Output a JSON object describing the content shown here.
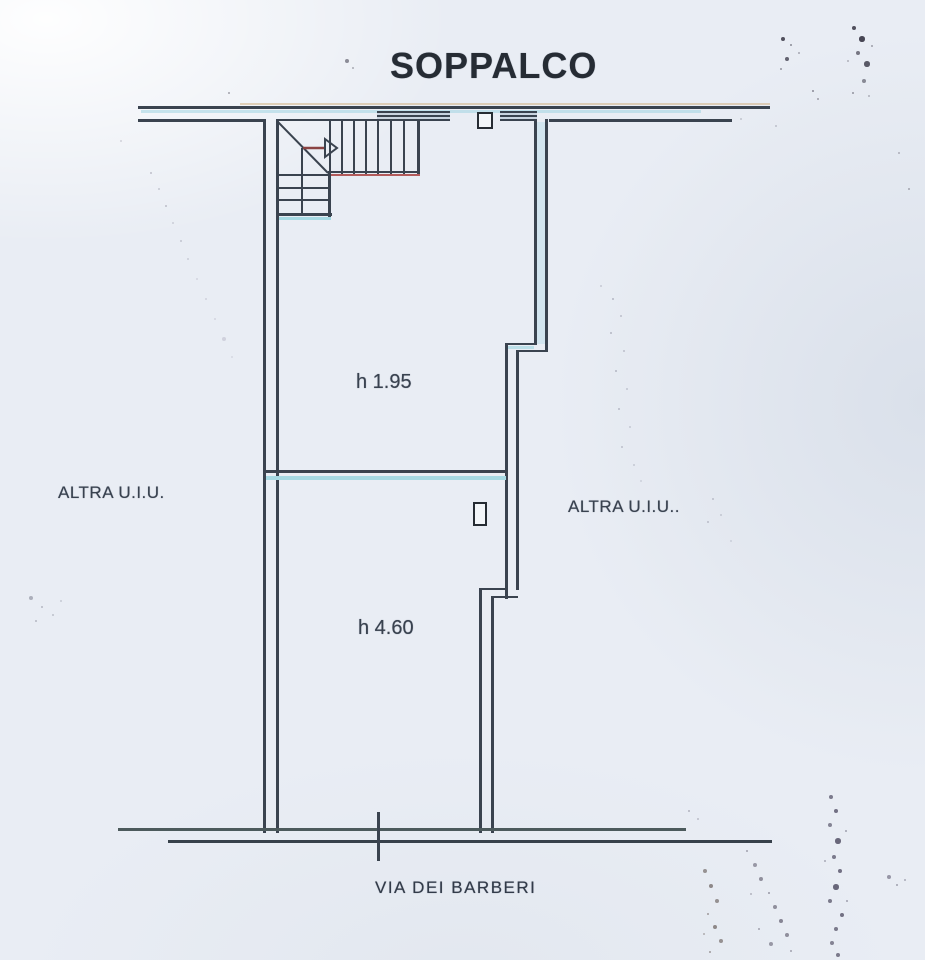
{
  "plan": {
    "title": "SOPPALCO",
    "room_heights": {
      "upper": "h 1.95",
      "lower": "h 4.60"
    },
    "adjacent_units": {
      "left": "ALTRA U.I.U.",
      "right": "ALTRA U.I.U.."
    },
    "street_name": "VIA DEI BARBERI",
    "icons": {
      "stair_arrow": "arrow-right-icon"
    },
    "colors": {
      "paper": "#e9edf4",
      "ink": "#3a434f",
      "title_text": "#262c34",
      "cyan_highlight": "#a6d9e3",
      "red_accent": "#b35b5b",
      "tan_scan_tint": "#d2b285"
    }
  }
}
